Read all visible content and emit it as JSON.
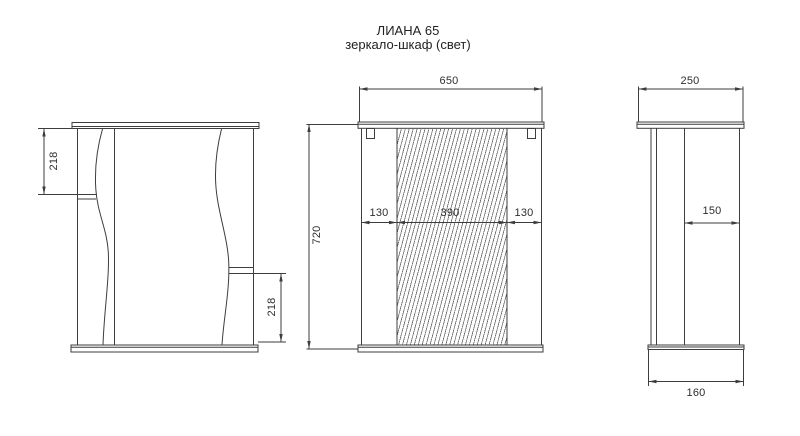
{
  "title": {
    "model": "ЛИАНА 65",
    "subtitle": "зеркало-шкаф (свет)"
  },
  "views": {
    "front": {
      "dims": {
        "upper_shelf_height": "218",
        "lower_shelf_height": "218"
      }
    },
    "main": {
      "dims": {
        "overall_width": "650",
        "overall_height": "720",
        "left_panel_width": "130",
        "mirror_width": "390",
        "right_panel_width": "130"
      }
    },
    "side": {
      "dims": {
        "top_depth": "250",
        "inner_depth": "150",
        "base_depth": "160"
      }
    }
  },
  "colors": {
    "background": "#ffffff",
    "line": "#3d3d3d",
    "hatch": "#6f6f6f",
    "text": "#2e2e2e"
  }
}
